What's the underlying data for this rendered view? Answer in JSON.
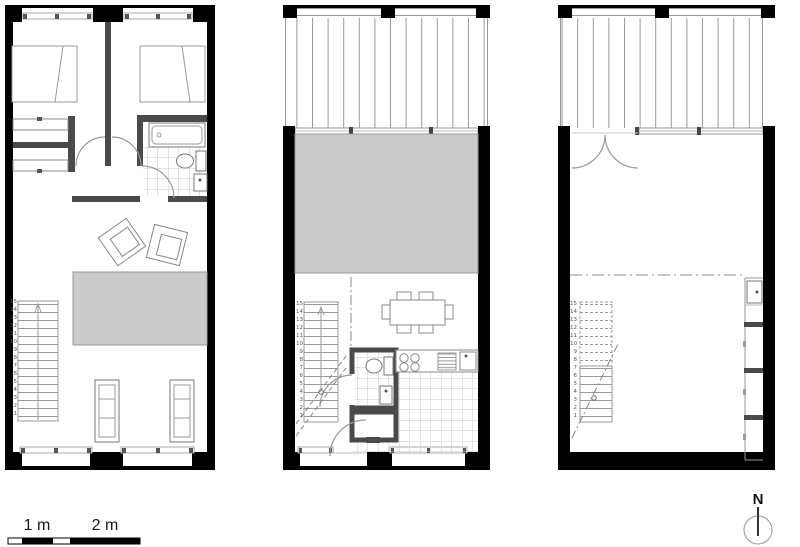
{
  "sheet": {
    "plans_count": 3,
    "colors": {
      "exterior_wall": "#000000",
      "interior_wall": "#4a4a4a",
      "area_fill": "#cbcbcb",
      "fixture_line": "#888888",
      "tile_line": "#c8c8c8"
    }
  },
  "scale_bar": {
    "label_1m": "1 m",
    "label_2m": "2 m"
  },
  "north_arrow": {
    "label": "N"
  },
  "stairs": {
    "steps": [
      "15",
      "14",
      "13",
      "12",
      "11",
      "10",
      "9",
      "8",
      "7",
      "6",
      "5",
      "4",
      "3",
      "2",
      "1"
    ]
  }
}
